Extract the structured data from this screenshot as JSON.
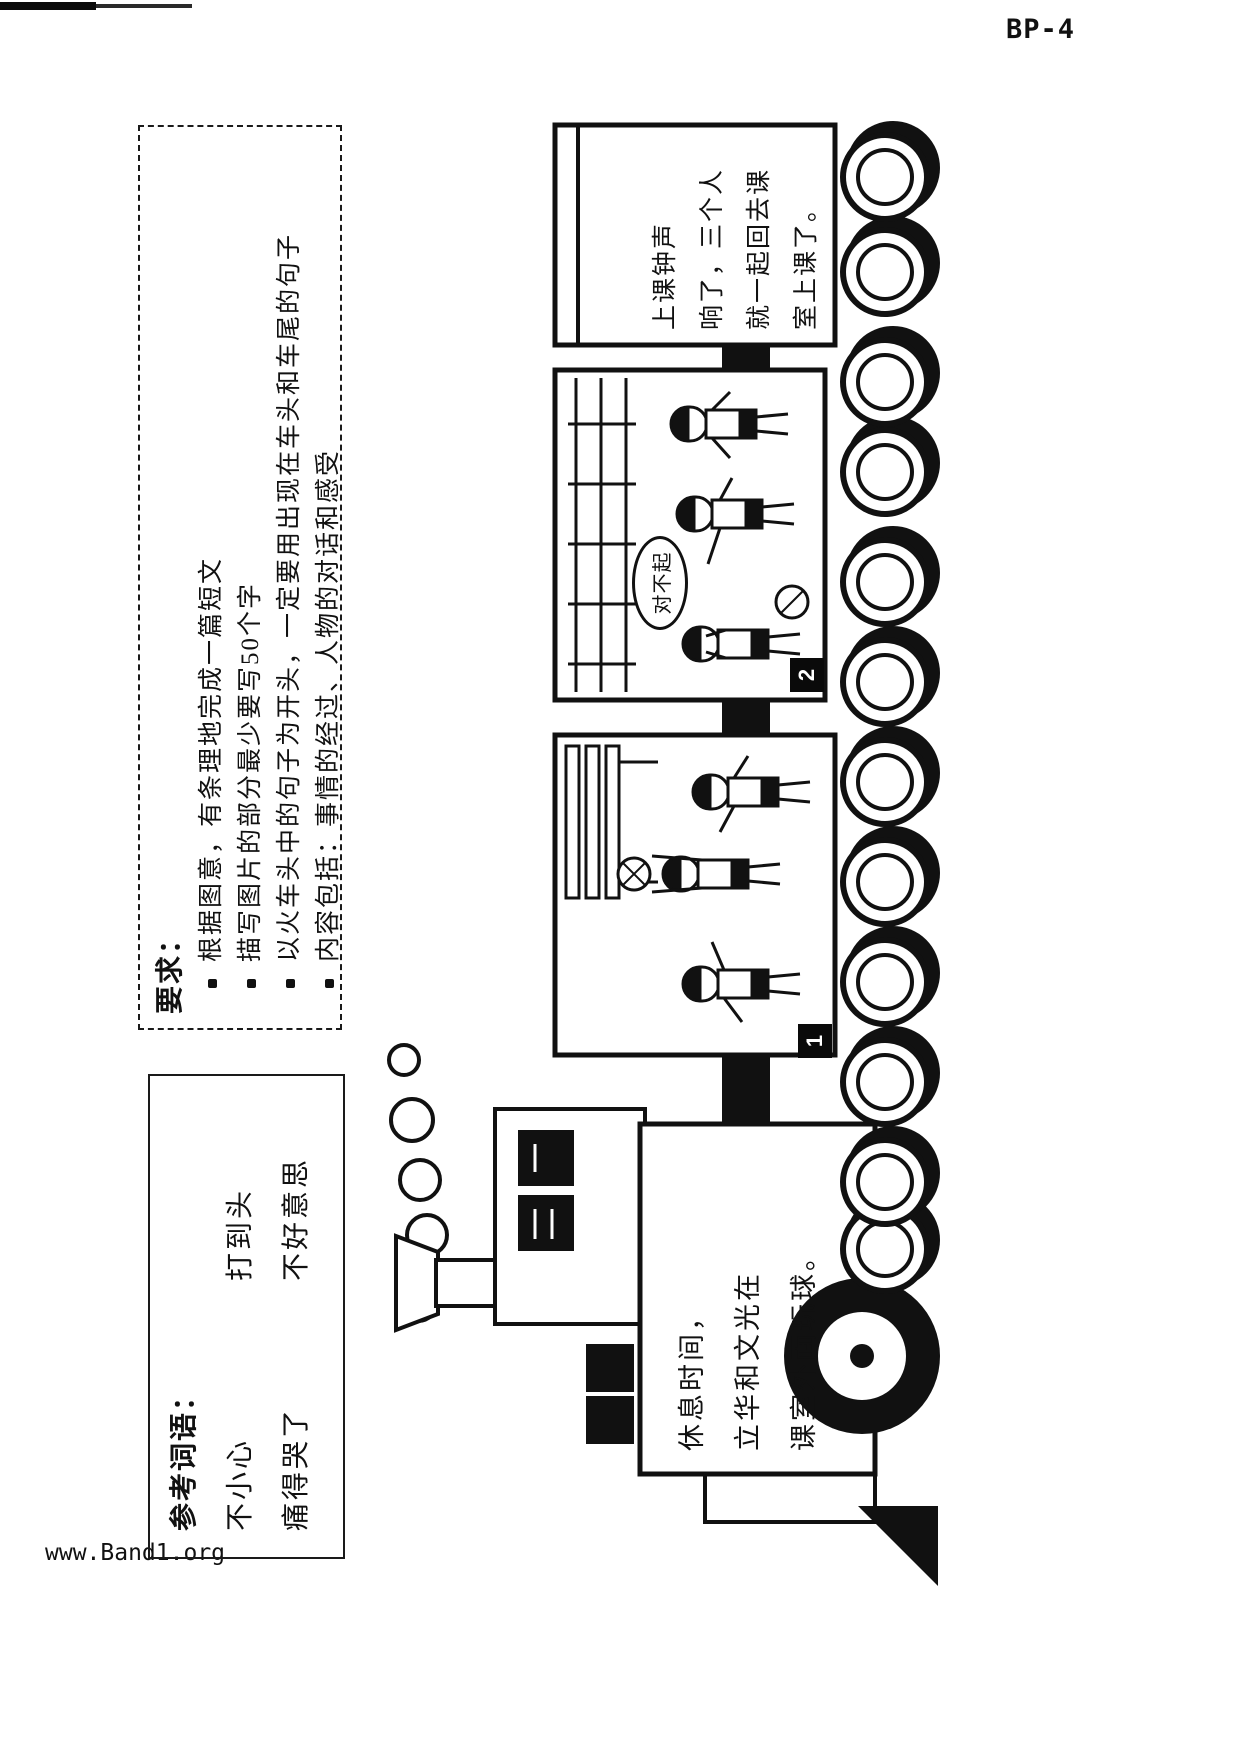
{
  "page": {
    "code": "BP-4",
    "footer": "www.Band1.org"
  },
  "requirements_box": {
    "title": "要求：",
    "bullets": [
      "根据图意，有条理地完成一篇短文",
      "描写图片的部分最少要写50个字",
      "以火车头中的句子为开头，一定要用出现在车头和车尾的句子",
      "内容包括：事情的经过、人物的对话和感受"
    ]
  },
  "reference_box": {
    "title": "参考词语：",
    "row1": [
      "不小心",
      "打到头"
    ],
    "row2": [
      "痛得哭了",
      "不好意思"
    ]
  },
  "train": {
    "engine_text": [
      "休息时间，",
      "立华和文光在",
      "课室外面玩球。"
    ],
    "caboose_text": [
      "上课钟声",
      "响了，三个人",
      "就一起回去课",
      "室上课了。"
    ],
    "picture1_label": "1",
    "picture2_label": "2",
    "speech_bubble": "对不起"
  }
}
